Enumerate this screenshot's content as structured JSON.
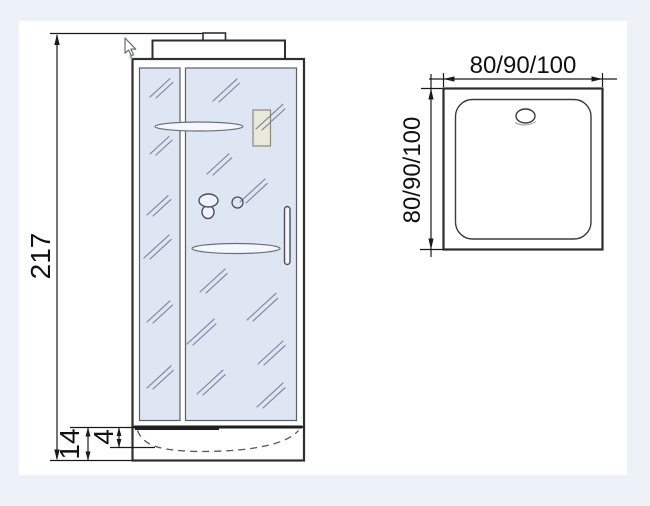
{
  "drawing_title": "shower-cabin-technical-drawing",
  "front_view": {
    "height_label": "217",
    "tray_height_label": "14",
    "tray_depth_label": "4"
  },
  "top_view": {
    "width_label": "80/90/100",
    "depth_label": "80/90/100"
  },
  "colors": {
    "background": "#edf1f8",
    "canvas": "#ffffff",
    "outline": "#2f2f2f",
    "dimension_line": "#1a1a1a",
    "glass": "#dee5f3",
    "glass_streak": "#79839a",
    "accessory_beige": "#eae7db"
  },
  "icons": {
    "cursor": "mouse-pointer-icon"
  }
}
